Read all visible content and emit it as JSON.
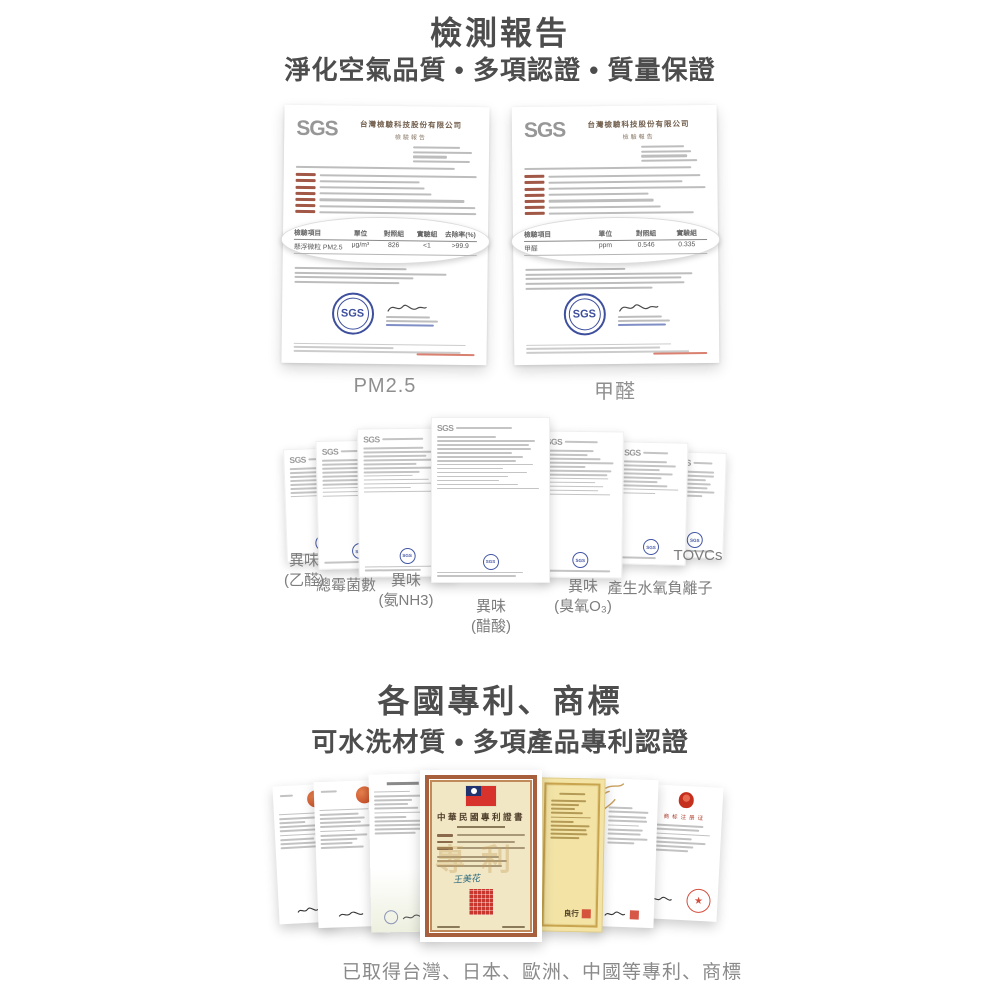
{
  "brand": {
    "sgs": "SGS"
  },
  "colors": {
    "title_text": "#4d4d4d",
    "caption_text": "#8f8f8f",
    "stamp_blue": "#3e4f9d",
    "seal_red": "#c8372d",
    "orange_seal": "#c2431f",
    "gold_paper": "#f3e4a6",
    "cream_paper": "#f2e7c4",
    "flag_red": "#d7322b",
    "flag_blue": "#20336e"
  },
  "section_test_report": {
    "title": "檢測報告",
    "subtitle": "淨化空氣品質 • 多項認證 • 質量保證",
    "certificates": [
      {
        "label": "PM2.5",
        "logo": "SGS",
        "issuer": "台灣檢驗科技股份有限公司",
        "doc_type": "檢驗報告",
        "table": {
          "headers": [
            "檢驗項目",
            "單位",
            "對照組",
            "實驗組",
            "去除率(%)"
          ],
          "rows": [
            [
              "懸浮微粒 PM2.5",
              "μg/m³",
              "826",
              "<1",
              ">99.9"
            ]
          ]
        }
      },
      {
        "label": "甲醛",
        "logo": "SGS",
        "issuer": "台灣檢驗科技股份有限公司",
        "doc_type": "檢驗報告",
        "table": {
          "headers": [
            "檢驗項目",
            "單位",
            "對照組",
            "實驗組"
          ],
          "rows": [
            [
              "甲醛",
              "ppm",
              "0.546",
              "0.335"
            ]
          ]
        }
      }
    ],
    "mini_certificates": [
      {
        "label_line1": "異味",
        "label_line2": "(乙醛)"
      },
      {
        "label_line1": "總霉菌數",
        "label_line2": ""
      },
      {
        "label_line1": "異味",
        "label_line2": "(氨NH3)"
      },
      {
        "label_line1": "異味",
        "label_line2": "(醋酸)"
      },
      {
        "label_line1": "異味",
        "label_line2": "(臭氧O₃)"
      },
      {
        "label_line1": "產生水氧負離子",
        "label_line2": ""
      },
      {
        "label_line1": "TOVCs",
        "label_line2": ""
      }
    ]
  },
  "section_patents": {
    "title": "各國專利、商標",
    "subtitle": "可水洗材質 • 多項產品專利認證",
    "taiwan_patent": {
      "title": "中華民國專利證書",
      "watermark": "專利",
      "signature": "王美花"
    },
    "japan_patent": {
      "signature": "良行"
    },
    "china_trademark": {
      "title": "商标注册证",
      "star": "★"
    },
    "caption": "已取得台灣、日本、歐洲、中國等專利、商標"
  }
}
